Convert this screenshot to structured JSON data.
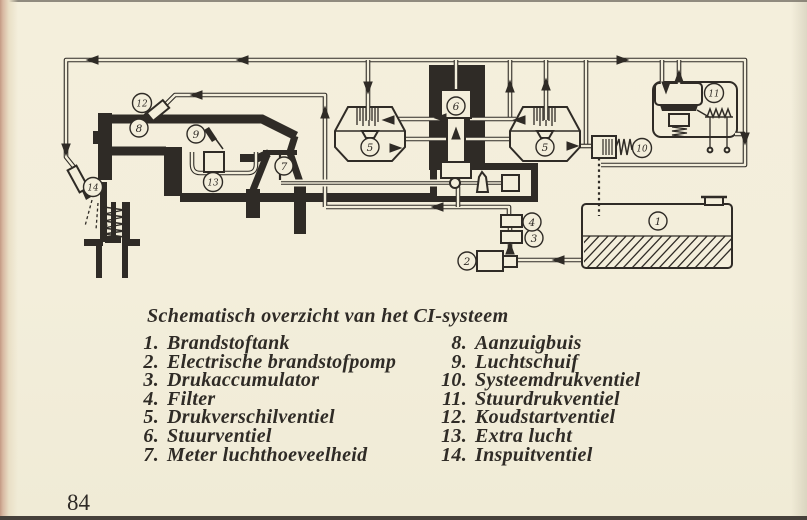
{
  "caption": "Schematisch overzicht van het CI-systeem",
  "page_number": "84",
  "legend": {
    "left": [
      {
        "num": "1.",
        "label": "Brandstoftank"
      },
      {
        "num": "2.",
        "label": "Electrische brandstofpomp"
      },
      {
        "num": "3.",
        "label": "Drukaccumulator"
      },
      {
        "num": "4.",
        "label": "Filter"
      },
      {
        "num": "5.",
        "label": "Drukverschilventiel"
      },
      {
        "num": "6.",
        "label": "Stuurventiel"
      },
      {
        "num": "7.",
        "label": "Meter luchthoeveelheid"
      }
    ],
    "right": [
      {
        "num": "8.",
        "label": "Aanzuigbuis"
      },
      {
        "num": "9.",
        "label": "Luchtschuif"
      },
      {
        "num": "10.",
        "label": "Systeemdrukventiel"
      },
      {
        "num": "11.",
        "label": "Stuurdrukventiel"
      },
      {
        "num": "12.",
        "label": "Koudstartventiel"
      },
      {
        "num": "13.",
        "label": "Extra lucht"
      },
      {
        "num": "14.",
        "label": "Inspuitventiel"
      }
    ]
  },
  "diagram": {
    "callouts": {
      "c1": "1",
      "c2": "2",
      "c3": "3",
      "c4": "4",
      "c5_left": "5",
      "c5_right": "5",
      "c6": "6",
      "c7": "7",
      "c8": "8",
      "c9": "9",
      "c10": "10",
      "c11": "11",
      "c12": "12",
      "c13": "13",
      "c14": "14"
    }
  },
  "colors": {
    "paper": "#f3eedb",
    "ink": "#2f2b26",
    "gutter": "#c49a84"
  }
}
